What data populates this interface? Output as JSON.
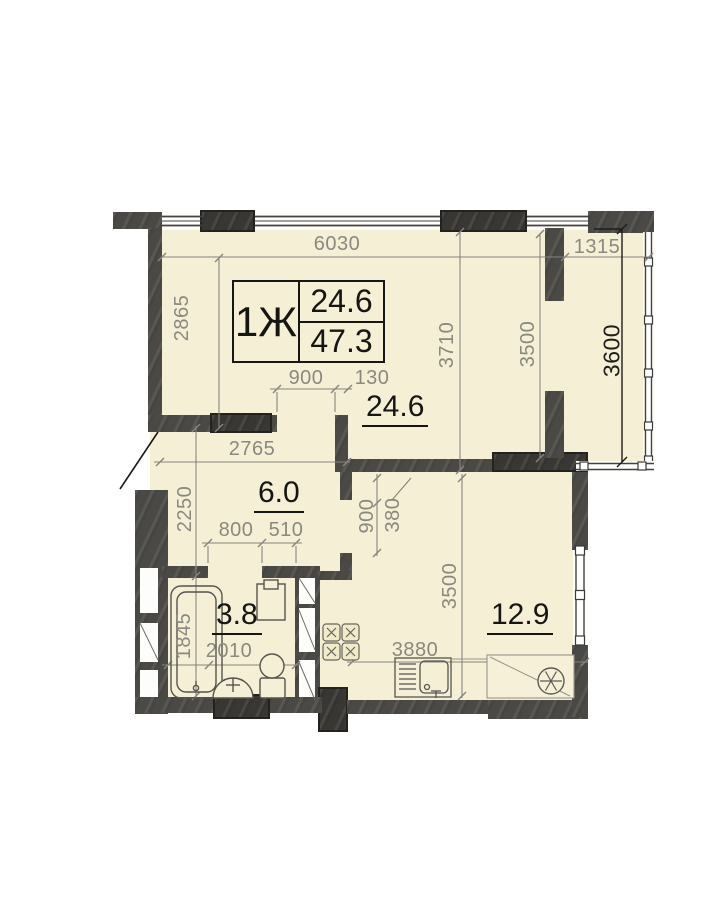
{
  "floor_plan": {
    "unit_box": {
      "type": "1Ж",
      "living_area": "24.6",
      "total_area": "47.3"
    },
    "room_labels": {
      "living": "24.6",
      "hall": "6.0",
      "bathroom": "3.8",
      "kitchen": "12.9"
    },
    "dimensions": {
      "top_width": "6030",
      "balcony_width": "1315",
      "left_height": "2865",
      "living_height": "3710",
      "living_height_2": "3500",
      "balcony_height": "3600",
      "opening_width": "900",
      "wall_thickness": "130",
      "hall_width": "2765",
      "hall_height": "2250",
      "bath_door_width": "800",
      "pier_width": "510",
      "kitchen_door_height": "900",
      "door_offset": "380",
      "kitchen_height": "3500",
      "bath_length": "1845",
      "bath_width": "2010",
      "kitchen_width": "3880"
    },
    "colors": {
      "room_fill": "#f5efd6",
      "wall": "#4a4945",
      "dim_text": "#8a8980",
      "label_text": "#151513"
    },
    "fixtures": [
      "bathtub",
      "wash-basin",
      "toilet",
      "washing-machine",
      "stove",
      "kitchen-sink",
      "ventilation-shaft",
      "ac-unit"
    ]
  }
}
